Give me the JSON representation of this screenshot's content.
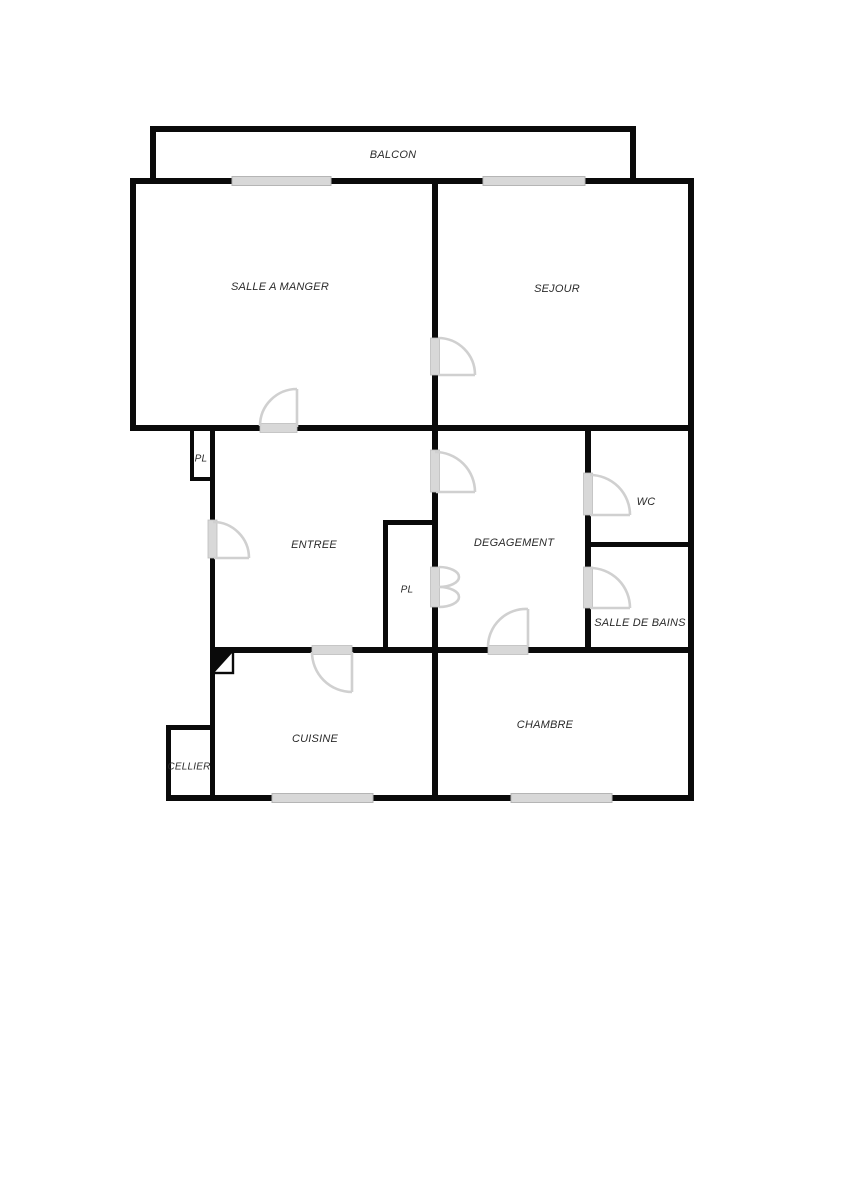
{
  "page": {
    "type": "apartment-floor-plan",
    "background": "#ffffff"
  },
  "colors": {
    "wall": "#0a0a0a",
    "opening_fill": "#d8d8d8",
    "door_arc": "#d0d0d0",
    "label_text": "#2b2b2b"
  },
  "rooms": {
    "balcon": {
      "label": "BALCON"
    },
    "salle_a_manger": {
      "label": "SALLE A MANGER"
    },
    "sejour": {
      "label": "SEJOUR"
    },
    "pl_entree": {
      "label": "PL"
    },
    "entree": {
      "label": "ENTREE"
    },
    "degagement": {
      "label": "DEGAGEMENT"
    },
    "wc": {
      "label": "WC"
    },
    "pl_degagement": {
      "label": "PL"
    },
    "salle_de_bains": {
      "label": "SALLE DE BAINS"
    },
    "cuisine": {
      "label": "CUISINE"
    },
    "chambre": {
      "label": "CHAMBRE"
    },
    "cellier": {
      "label": "CELLIER"
    }
  },
  "features": {
    "windows": [
      {
        "room": "salle_a_manger",
        "side": "top"
      },
      {
        "room": "sejour",
        "side": "top"
      },
      {
        "room": "cuisine",
        "side": "bottom"
      },
      {
        "room": "chambre",
        "side": "bottom"
      }
    ],
    "doors": [
      {
        "from": "entree",
        "to": "salle_a_manger"
      },
      {
        "from": "exterior",
        "to": "entree"
      },
      {
        "from": "entree",
        "to": "degagement"
      },
      {
        "from": "salle_a_manger",
        "to": "sejour"
      },
      {
        "from": "degagement",
        "to": "wc"
      },
      {
        "from": "degagement",
        "to": "salle_de_bains"
      },
      {
        "from": "degagement",
        "to": "pl_degagement",
        "type": "double-fold"
      },
      {
        "from": "entree",
        "to": "cuisine"
      },
      {
        "from": "degagement",
        "to": "chambre"
      }
    ]
  }
}
